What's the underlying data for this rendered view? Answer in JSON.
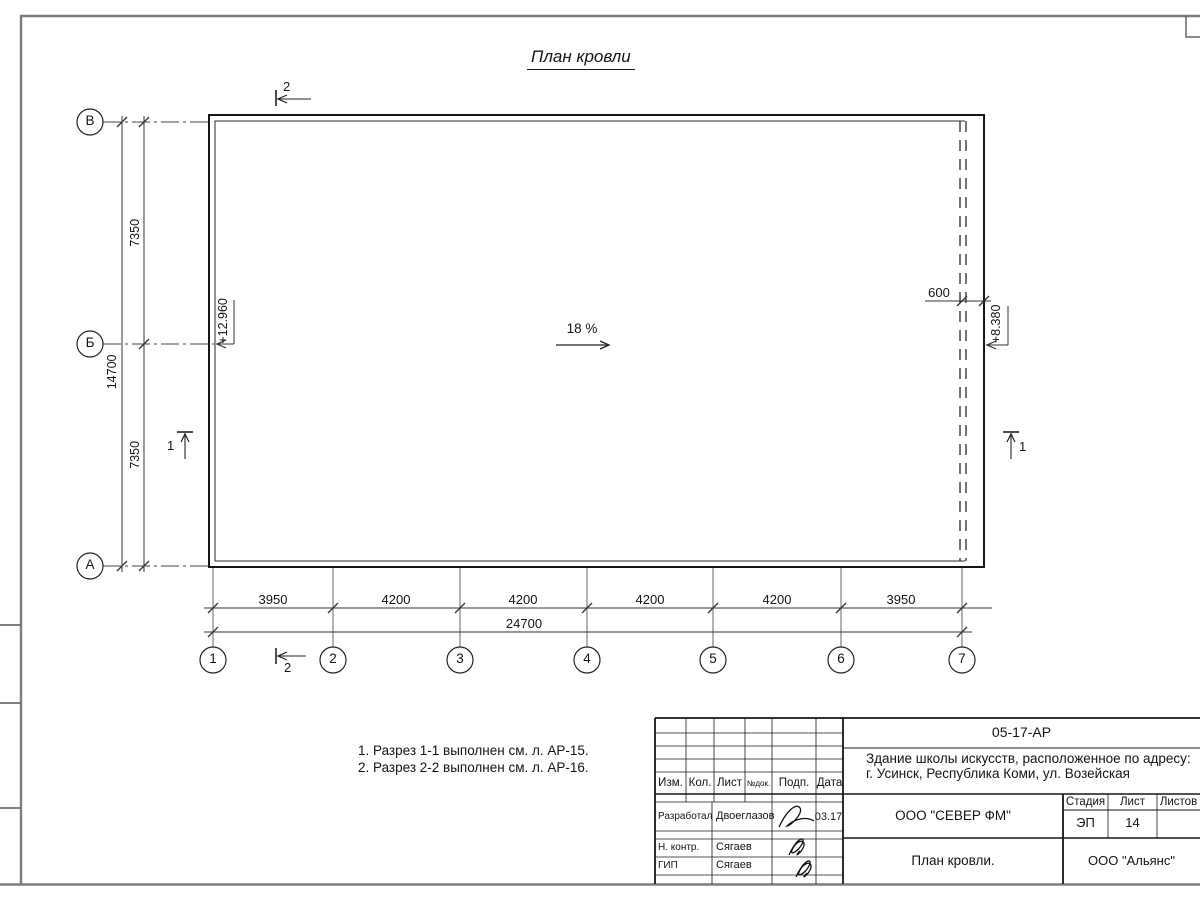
{
  "drawing": {
    "title": "План кровли",
    "slope_label": "18 %",
    "elevation_left": "+12.960",
    "elevation_right": "+8.380",
    "overhang_dim": "600",
    "axes_vertical": [
      "В",
      "Б",
      "А"
    ],
    "axes_horizontal": [
      "1",
      "2",
      "3",
      "4",
      "5",
      "6",
      "7"
    ],
    "dim_left_segments": [
      "7350",
      "7350"
    ],
    "dim_left_total": "14700",
    "dim_bottom_segments": [
      "3950",
      "4200",
      "4200",
      "4200",
      "4200",
      "3950"
    ],
    "dim_bottom_total": "24700",
    "section_1": "1",
    "section_2": "2",
    "notes": [
      "1. Разрез 1-1 выполнен см. л. АР-15.",
      "2. Разрез 2-2 выполнен см. л. АР-16."
    ]
  },
  "titleblock": {
    "doc_code": "05-17-АР",
    "object_address_line1": "Здание школы искусств, расположенное по адресу:",
    "object_address_line2": "г. Усинск, Республика Коми, ул. Возейская",
    "rev_headers": [
      "Изм.",
      "Кол.",
      "Лист",
      "№док.",
      "Подп.",
      "Дата"
    ],
    "staff": [
      {
        "role": "Разработал",
        "name": "Двоеглазов",
        "date": "03.17"
      },
      {
        "role": "Н. контр.",
        "name": "Сягаев",
        "date": ""
      },
      {
        "role": "ГИП",
        "name": "Сягаев",
        "date": ""
      }
    ],
    "org_center": "ООО \"СЕВЕР ФМ\"",
    "stage_label": "Стадия",
    "sheet_label": "Лист",
    "sheets_label": "Листов",
    "stage": "ЭП",
    "sheet_number": "14",
    "sheets_total": "",
    "sheet_title": "План кровли.",
    "org_right": "ООО \"Альянс\""
  }
}
